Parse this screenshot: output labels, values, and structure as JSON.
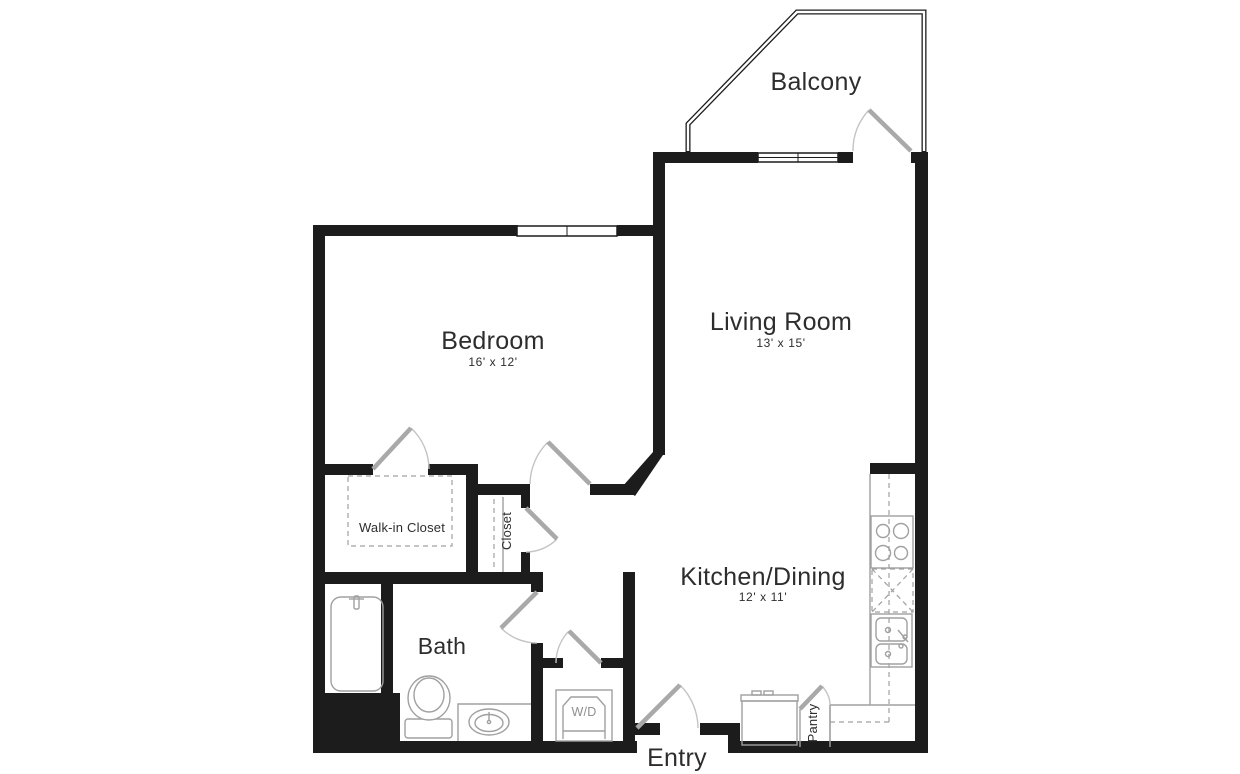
{
  "plan": {
    "title": "One-bedroom apartment floor plan",
    "colors": {
      "background": "#ffffff",
      "wall": "#1c1c1c",
      "door_leaf": "#a9a9a9",
      "door_arc": "#c4c4c4",
      "fixture_line": "#a0a0a0",
      "label_text": "#2d2d2d",
      "muted_text": "#8f8f8f"
    },
    "rooms": {
      "balcony": {
        "label": "Balcony"
      },
      "living": {
        "label": "Living Room",
        "dims": "13' x 15'"
      },
      "bedroom": {
        "label": "Bedroom",
        "dims": "16' x 12'"
      },
      "kitchen": {
        "label": "Kitchen/Dining",
        "dims": "12' x 11'"
      },
      "bath": {
        "label": "Bath"
      },
      "walk_in_closet": {
        "label": "Walk-in Closet"
      },
      "closet": {
        "label": "Closet"
      },
      "pantry": {
        "label": "Pantry"
      },
      "laundry": {
        "label": "W/D"
      },
      "entry": {
        "label": "Entry"
      }
    },
    "fixtures": [
      "bathtub",
      "toilet",
      "bathroom-sink",
      "washer-dryer",
      "refrigerator",
      "stove-cooktop",
      "dishwasher",
      "kitchen-double-sink",
      "kitchen-counter",
      "upper-cabinets-dashed",
      "closet-shelving-dashed"
    ]
  }
}
